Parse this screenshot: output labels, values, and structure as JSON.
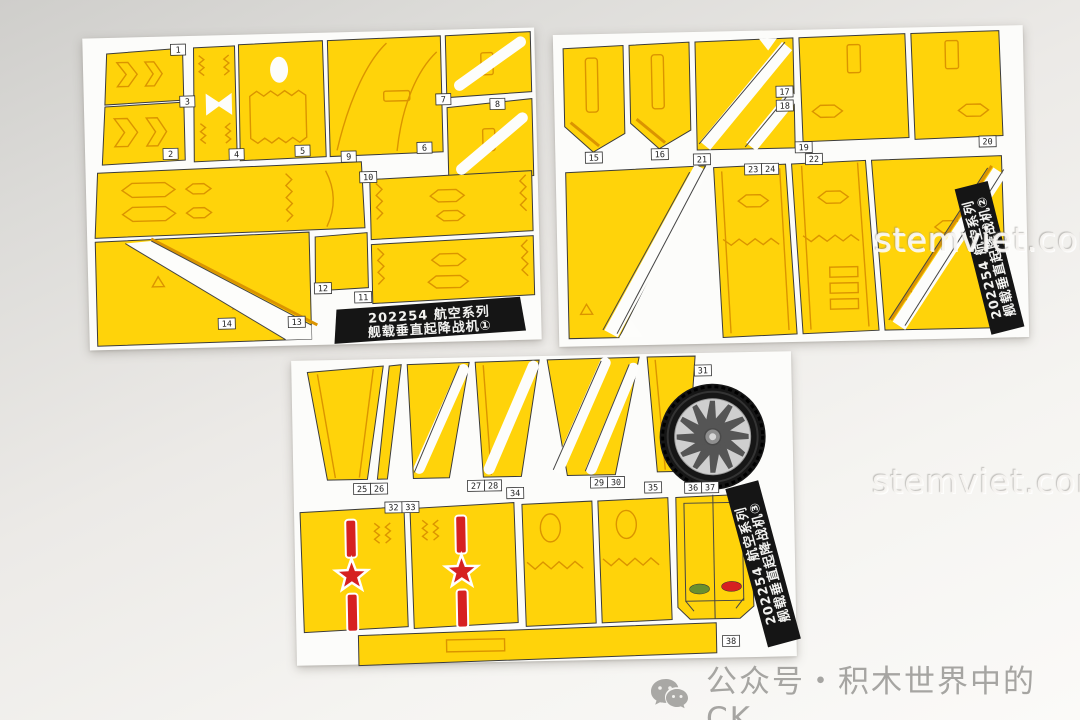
{
  "kit": {
    "product_code": "202254",
    "series": "航空系列",
    "model_name": "舰载垂直起降战机"
  },
  "watermark": {
    "text": "stemviet.com"
  },
  "footer": {
    "text": "公众号・积木世界中的CK",
    "icon": "wechat-bubbles-icon"
  },
  "colors": {
    "sticker_yellow": "#FFD30A",
    "detail_orange": "#DB9400",
    "insignia_red": "#D62121",
    "label_black": "#151515",
    "sheet_white": "#FCFCFA",
    "footer_gray": "#A6A5A2"
  },
  "sheets": [
    {
      "name": "sticker-sheet-1",
      "label_line1": "202254 航空系列",
      "label_line2": "舰载垂直起降战机①",
      "tabs": [
        "1",
        "2",
        "3",
        "4",
        "5",
        "6",
        "7",
        "8",
        "9",
        "10",
        "11",
        "12",
        "13",
        "14"
      ]
    },
    {
      "name": "sticker-sheet-2",
      "label_line1": "202254 航空系列",
      "label_line2": "舰载垂直起降战机②",
      "tabs": [
        "15",
        "16",
        "17",
        "18",
        "19",
        "20",
        "21",
        "22",
        "23",
        "24"
      ]
    },
    {
      "name": "sticker-sheet-3",
      "label_line1": "202254 航空系列",
      "label_line2": "舰载垂直起降战机③",
      "tabs": [
        "25",
        "26",
        "27",
        "28",
        "29",
        "30",
        "31",
        "32",
        "33",
        "34",
        "35",
        "36",
        "37",
        "38"
      ]
    }
  ]
}
